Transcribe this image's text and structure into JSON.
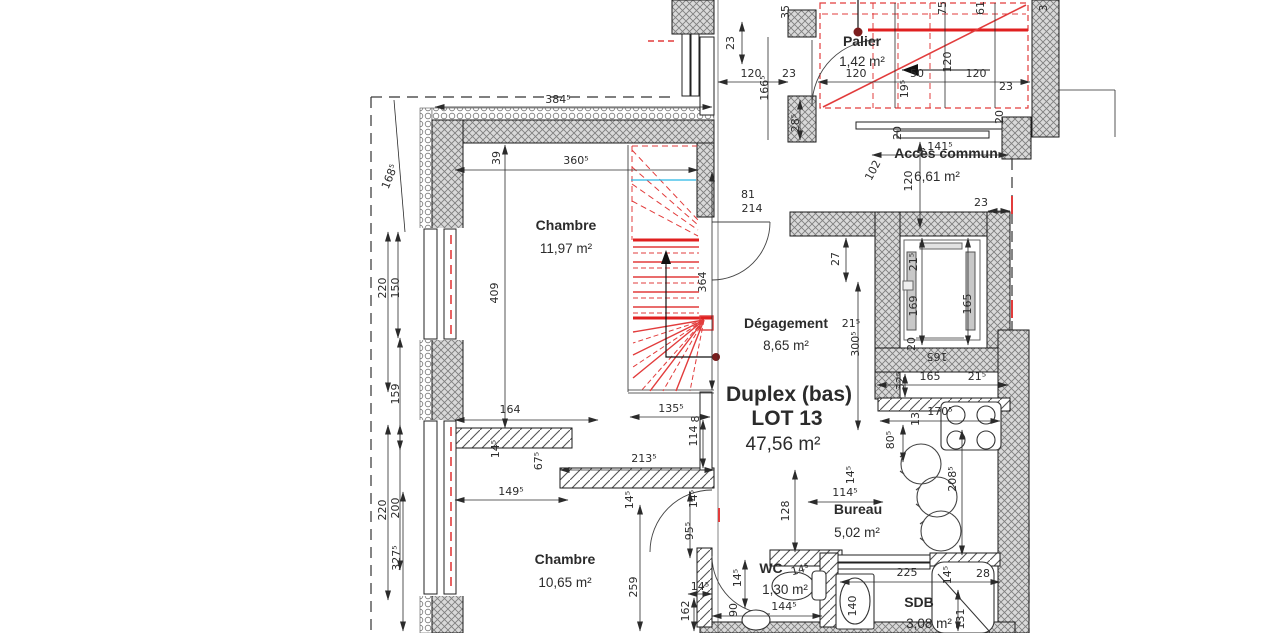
{
  "drawing": {
    "type": "architectural-floor-plan",
    "lot": {
      "name": "Duplex (bas)",
      "lot_number": "LOT 13",
      "total_area": "47,56 m²"
    },
    "colors": {
      "walls": "#d9d9d9",
      "wall_lines": "#808080",
      "stair_red": "#e23c3c",
      "stair_red_strong": "#e02020",
      "level_cyan": "#29b8e5",
      "text": "#2b2b2b"
    }
  },
  "rooms": [
    {
      "name": "Palier",
      "area": "1,42 m²",
      "nx": 862,
      "ny": 46,
      "ax": 862,
      "ay": 66
    },
    {
      "name": "Accès commun",
      "area": "6,61 m²",
      "nx": 946,
      "ny": 158,
      "ax": 937,
      "ay": 181
    },
    {
      "name": "Chambre",
      "area": "11,97 m²",
      "nx": 566,
      "ny": 230,
      "ax": 566,
      "ay": 253
    },
    {
      "name": "Dégagement",
      "area": "8,65 m²",
      "nx": 786,
      "ny": 328,
      "ax": 786,
      "ay": 350
    },
    {
      "name": "Duplex (bas)",
      "name2": "LOT 13",
      "area": "47,56 m²",
      "nx": 789,
      "ny": 401,
      "n2x": 787,
      "n2y": 425,
      "ax": 783,
      "ay": 450,
      "big": true
    },
    {
      "name": "Bureau",
      "area": "5,02 m²",
      "nx": 858,
      "ny": 514,
      "ax": 857,
      "ay": 537
    },
    {
      "name": "Chambre",
      "area": "10,65 m²",
      "nx": 565,
      "ny": 564,
      "ax": 565,
      "ay": 587
    },
    {
      "name": "WC",
      "area": "1,30 m²",
      "nx": 771,
      "ny": 573,
      "ax": 785,
      "ay": 594
    },
    {
      "name": "SDB",
      "area": "3,08 m²",
      "nx": 919,
      "ny": 607,
      "ax": 929,
      "ay": 628
    }
  ],
  "dimensions": [
    {
      "t": "384⁵",
      "x": 558,
      "y": 103,
      "r": 0
    },
    {
      "t": "39",
      "x": 500,
      "y": 158,
      "r": -90
    },
    {
      "t": "360⁵",
      "x": 576,
      "y": 164,
      "r": 0
    },
    {
      "t": "364",
      "x": 706,
      "y": 282,
      "r": -90
    },
    {
      "t": "409",
      "x": 498,
      "y": 293,
      "r": -90
    },
    {
      "t": "168⁵",
      "x": 393,
      "y": 178,
      "r": -68
    },
    {
      "t": "220",
      "x": 386,
      "y": 288,
      "r": -90
    },
    {
      "t": "150",
      "x": 399,
      "y": 288,
      "r": -90
    },
    {
      "t": "159",
      "x": 399,
      "y": 394,
      "r": -90
    },
    {
      "t": "220",
      "x": 386,
      "y": 510,
      "r": -90
    },
    {
      "t": "200",
      "x": 399,
      "y": 508,
      "r": -90
    },
    {
      "t": "164",
      "x": 510,
      "y": 413,
      "r": 0
    },
    {
      "t": "135⁵",
      "x": 671,
      "y": 412,
      "r": 0
    },
    {
      "t": "8",
      "x": 699,
      "y": 419,
      "r": -90
    },
    {
      "t": "81",
      "x": 748,
      "y": 198,
      "r": 0
    },
    {
      "t": "214",
      "x": 752,
      "y": 212,
      "r": 0
    },
    {
      "t": "23",
      "x": 734,
      "y": 43,
      "r": -90
    },
    {
      "t": "120",
      "x": 751,
      "y": 77,
      "r": 0
    },
    {
      "t": "23",
      "x": 789,
      "y": 77,
      "r": 0
    },
    {
      "t": "166⁵",
      "x": 768,
      "y": 88,
      "r": -90
    },
    {
      "t": "35",
      "x": 789,
      "y": 12,
      "r": -90
    },
    {
      "t": "28⁵",
      "x": 799,
      "y": 123,
      "r": -90
    },
    {
      "t": "120",
      "x": 856,
      "y": 77,
      "r": 0
    },
    {
      "t": "50",
      "x": 917,
      "y": 77,
      "r": 0
    },
    {
      "t": "19⁵",
      "x": 908,
      "y": 89,
      "r": -90
    },
    {
      "t": "120",
      "x": 951,
      "y": 62,
      "r": -90
    },
    {
      "t": "120",
      "x": 976,
      "y": 77,
      "r": 0
    },
    {
      "t": "23",
      "x": 1006,
      "y": 90,
      "r": 0
    },
    {
      "t": "75",
      "x": 946,
      "y": 8,
      "r": -90
    },
    {
      "t": "61",
      "x": 984,
      "y": 8,
      "r": -90
    },
    {
      "t": "3",
      "x": 1047,
      "y": 8,
      "r": -90
    },
    {
      "t": "20",
      "x": 1003,
      "y": 117,
      "r": -90
    },
    {
      "t": "141⁵",
      "x": 940,
      "y": 150,
      "r": 0
    },
    {
      "t": "20",
      "x": 901,
      "y": 133,
      "r": -90
    },
    {
      "t": "120",
      "x": 912,
      "y": 181,
      "r": -90
    },
    {
      "t": "102",
      "x": 876,
      "y": 172,
      "r": -62
    },
    {
      "t": "23",
      "x": 981,
      "y": 206,
      "r": 0
    },
    {
      "t": "21⁵",
      "x": 917,
      "y": 262,
      "r": -90
    },
    {
      "t": "169",
      "x": 917,
      "y": 306,
      "r": -90
    },
    {
      "t": "165",
      "x": 971,
      "y": 304,
      "r": -90
    },
    {
      "t": "27",
      "x": 839,
      "y": 259,
      "r": -90
    },
    {
      "t": "21⁵",
      "x": 851,
      "y": 327,
      "r": 0
    },
    {
      "t": "300⁵",
      "x": 859,
      "y": 344,
      "r": -90
    },
    {
      "t": "165",
      "x": 930,
      "y": 380,
      "r": 0
    },
    {
      "t": "21⁵",
      "x": 977,
      "y": 380,
      "r": 0
    },
    {
      "t": "20",
      "x": 915,
      "y": 344,
      "r": -90
    },
    {
      "t": "165",
      "x": 937,
      "y": 353,
      "r": 180
    },
    {
      "t": "32⁵",
      "x": 904,
      "y": 381,
      "r": -90
    },
    {
      "t": "170⁵",
      "x": 940,
      "y": 415,
      "r": 0
    },
    {
      "t": "13",
      "x": 919,
      "y": 419,
      "r": -90
    },
    {
      "t": "80⁵",
      "x": 894,
      "y": 440,
      "r": -90
    },
    {
      "t": "208⁵",
      "x": 956,
      "y": 479,
      "r": -90
    },
    {
      "t": "128",
      "x": 789,
      "y": 511,
      "r": -90
    },
    {
      "t": "114⁵",
      "x": 845,
      "y": 496,
      "r": 0
    },
    {
      "t": "14⁵",
      "x": 854,
      "y": 475,
      "r": -90
    },
    {
      "t": "213⁵",
      "x": 644,
      "y": 462,
      "r": 0
    },
    {
      "t": "14⁵",
      "x": 499,
      "y": 449,
      "r": -90
    },
    {
      "t": "67⁵",
      "x": 542,
      "y": 461,
      "r": -90
    },
    {
      "t": "149⁵",
      "x": 511,
      "y": 495,
      "r": 0
    },
    {
      "t": "14⁵",
      "x": 633,
      "y": 500,
      "r": -90
    },
    {
      "t": "114",
      "x": 697,
      "y": 436,
      "r": -90
    },
    {
      "t": "14⁵",
      "x": 697,
      "y": 499,
      "r": -90
    },
    {
      "t": "95⁵",
      "x": 693,
      "y": 531,
      "r": -90
    },
    {
      "t": "327⁵",
      "x": 400,
      "y": 558,
      "r": -90
    },
    {
      "t": "259",
      "x": 637,
      "y": 587,
      "r": -90
    },
    {
      "t": "162",
      "x": 689,
      "y": 611,
      "r": -90
    },
    {
      "t": "14⁵",
      "x": 700,
      "y": 590,
      "r": 0
    },
    {
      "t": "14⁵",
      "x": 741,
      "y": 578,
      "r": -90
    },
    {
      "t": "90",
      "x": 737,
      "y": 610,
      "r": -90
    },
    {
      "t": "144⁵",
      "x": 784,
      "y": 610,
      "r": 0
    },
    {
      "t": "14⁵",
      "x": 801,
      "y": 573,
      "r": -15
    },
    {
      "t": "140",
      "x": 856,
      "y": 606,
      "r": -90
    },
    {
      "t": "225",
      "x": 907,
      "y": 576,
      "r": 0
    },
    {
      "t": "14⁵",
      "x": 951,
      "y": 575,
      "r": -90
    },
    {
      "t": "28",
      "x": 983,
      "y": 577,
      "r": 0
    },
    {
      "t": "131",
      "x": 964,
      "y": 619,
      "r": -90
    }
  ]
}
